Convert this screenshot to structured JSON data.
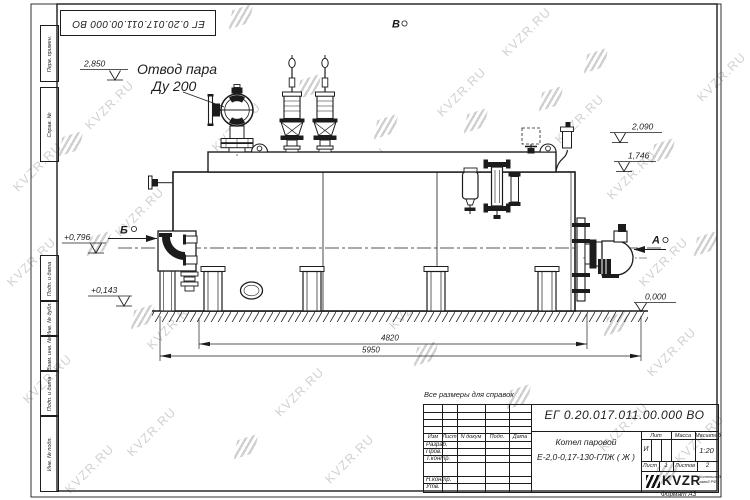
{
  "watermark": {
    "text": "KVZR.RU"
  },
  "stamp_top": {
    "doc_number": "ЕГ 0.20.017.011.00.000  ВО"
  },
  "note": "Все размеры для справок",
  "labels": {
    "steam_outlet_line1": "Отвод пара",
    "steam_outlet_line2": "Ду 200",
    "elev_2850": "2,850",
    "elev_2090": "2,090",
    "elev_1746": "1,746",
    "elev_0796": "+0,796",
    "elev_0143": "+0,143",
    "elev_0000": "0,000",
    "dim_4820": "4820",
    "dim_5950": "5950",
    "view_a": "А",
    "view_b": "Б",
    "view_v": "В"
  },
  "margin": {
    "items": [
      "Перв. примен.",
      "Справ. №",
      "Подп. и дата",
      "Инв. № дубл.",
      "Взам. инв. №",
      "Подп. и дата",
      "Инв. № подл."
    ]
  },
  "title_block": {
    "doc_number": "ЕГ 0.20.017.011.00.000  ВО",
    "product_name_line1": "Котел паровой",
    "product_name_line2": "Е-2,0-0,17-130-ГЛЖ ( Ж )",
    "header_izm": "Изм",
    "header_list": "Лист",
    "header_ndoc": "N докум",
    "header_podp": "Подп.",
    "header_data": "Дата",
    "row_razrab": "Разраб.",
    "row_prov": "Пров.",
    "row_tkontr": "Т.контр.",
    "row_nkontr": "Н.контр.",
    "row_utv": "Утв.",
    "lit_label": "Лит",
    "lit_value": "И",
    "massa_label": "Масса",
    "masshtab_label": "Масштаб",
    "masshtab_value": "1:20",
    "list_label": "Лист",
    "list_value": "1",
    "listov_label": "Листов",
    "listov_value": "2",
    "logo_text": "KVZR",
    "logo_sub_line1": "Котельный",
    "logo_sub_line2": "завод РФ",
    "format_label": "Формат А3"
  },
  "colors": {
    "line": "#1c1c1c",
    "watermark": "#c6c6c6",
    "paper": "#ffffff"
  }
}
